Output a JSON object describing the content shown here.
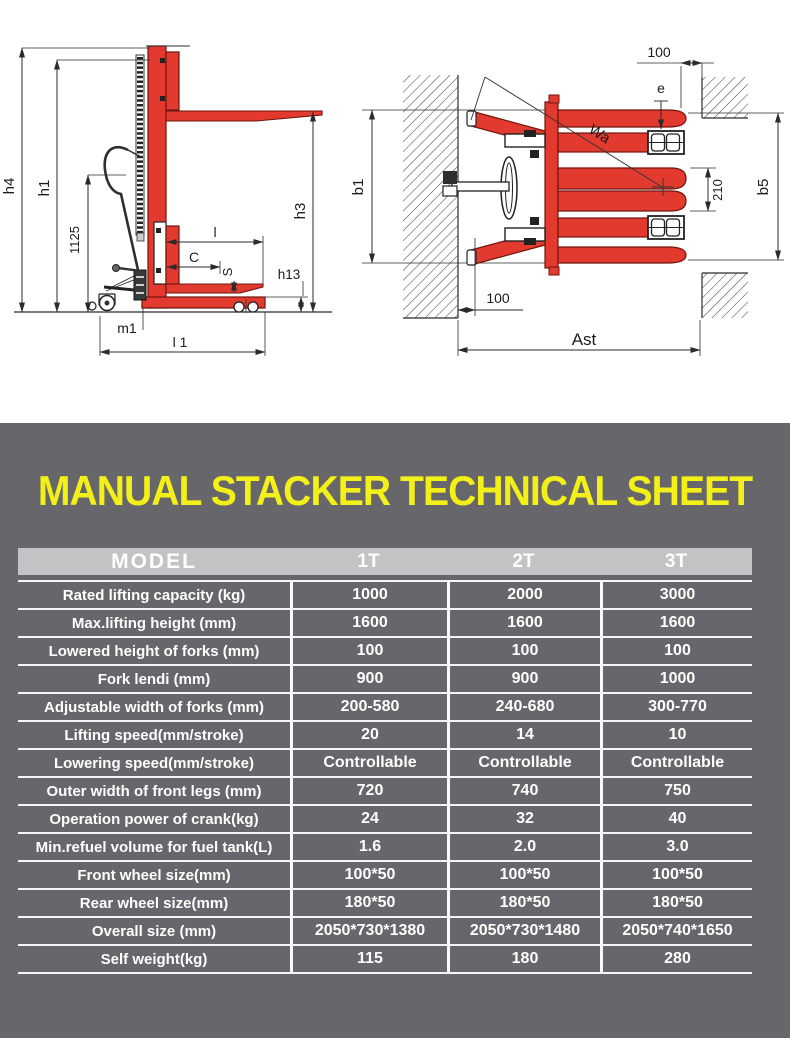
{
  "title": {
    "text": "MANUAL STACKER TECHNICAL SHEET"
  },
  "colors": {
    "accent_yellow": "#f3ef18",
    "panel_gray": "#67666a",
    "header_gray": "#c3c2c4",
    "drawing_red": "#e23a2e"
  },
  "diagram": {
    "side_view": {
      "labels": {
        "h4": "h4",
        "h1": "h1",
        "mast_height": "1125",
        "h3": "h3",
        "fork_length": "l",
        "load_center": "C",
        "fork_thickness": "S",
        "h13": "h13",
        "m1": "m1",
        "l1": "l 1"
      }
    },
    "top_view": {
      "labels": {
        "clearance_top": "100",
        "e": "e",
        "wa": "Wa",
        "fork_spread": "210",
        "b5": "b5",
        "b1": "b1",
        "clearance_side": "100",
        "ast": "Ast"
      }
    }
  },
  "table": {
    "header": {
      "model": "MODEL",
      "columns": [
        "1T",
        "2T",
        "3T"
      ]
    },
    "rows": [
      {
        "label": "Rated lifting capacity (kg)",
        "values": [
          "1000",
          "2000",
          "3000"
        ]
      },
      {
        "label": "Max.lifting height (mm)",
        "values": [
          "1600",
          "1600",
          "1600"
        ]
      },
      {
        "label": "Lowered height of forks (mm)",
        "values": [
          "100",
          "100",
          "100"
        ]
      },
      {
        "label": "Fork lendi (mm)",
        "values": [
          "900",
          "900",
          "1000"
        ]
      },
      {
        "label": "Adjustable width of forks (mm)",
        "values": [
          "200-580",
          "240-680",
          "300-770"
        ]
      },
      {
        "label": "Lifting speed(mm/stroke)",
        "values": [
          "20",
          "14",
          "10"
        ]
      },
      {
        "label": "Lowering speed(mm/stroke)",
        "values": [
          "Controllable",
          "Controllable",
          "Controllable"
        ]
      },
      {
        "label": "Outer width of front legs (mm)",
        "values": [
          "720",
          "740",
          "750"
        ]
      },
      {
        "label": "Operation power of crank(kg)",
        "values": [
          "24",
          "32",
          "40"
        ]
      },
      {
        "label": "Min.refuel volume for fuel tank(L)",
        "values": [
          "1.6",
          "2.0",
          "3.0"
        ]
      },
      {
        "label": "Front wheel size(mm)",
        "values": [
          "100*50",
          "100*50",
          "100*50"
        ]
      },
      {
        "label": "Rear wheel size(mm)",
        "values": [
          "180*50",
          "180*50",
          "180*50"
        ]
      },
      {
        "label": "Overall size (mm)",
        "values": [
          "2050*730*1380",
          "2050*730*1480",
          "2050*740*1650"
        ]
      },
      {
        "label": "Self weight(kg)",
        "values": [
          "115",
          "180",
          "280"
        ]
      }
    ]
  }
}
